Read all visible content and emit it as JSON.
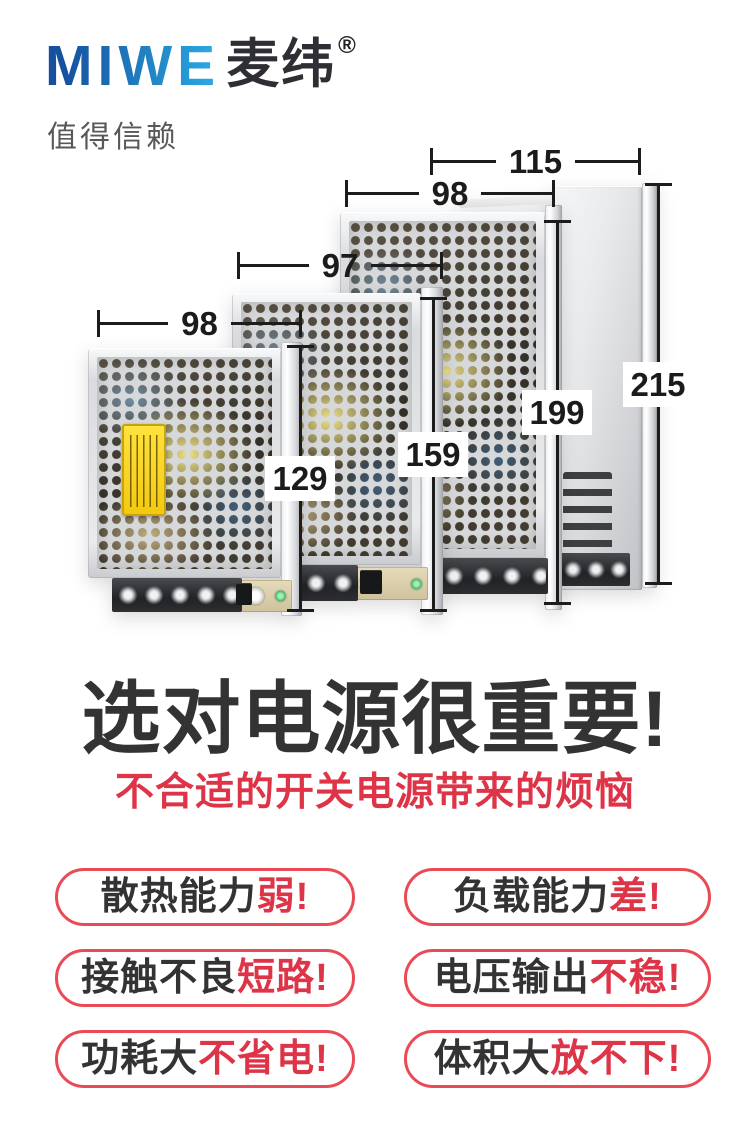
{
  "logo": {
    "en": "MIWE",
    "cn": "麦纬",
    "reg": "®",
    "tagline": "值得信赖"
  },
  "diagram": {
    "widths": {
      "slim": "115",
      "large": "98",
      "medium": "97",
      "small": "98"
    },
    "heights": {
      "small": "129",
      "medium": "159",
      "large": "199",
      "slim": "215"
    }
  },
  "headline": {
    "title": "选对电源很重要!",
    "subtitle": "不合适的开关电源带来的烦恼"
  },
  "pills": [
    {
      "text": "散热能力",
      "highlight": "弱!"
    },
    {
      "text": "负载能力",
      "highlight": "差!"
    },
    {
      "text": "接触不良",
      "highlight": "短路!"
    },
    {
      "text": "电压输出",
      "highlight": "不稳!"
    },
    {
      "text": "功耗大",
      "highlight": "不省电!"
    },
    {
      "text": "体积大",
      "highlight": "放不下!"
    }
  ],
  "colors": {
    "brand_blue_dark": "#16509e",
    "brand_blue_light": "#2aa7e0",
    "title": "#333333",
    "accent_red": "#dd3448",
    "pill_border": "#ea4a56"
  }
}
